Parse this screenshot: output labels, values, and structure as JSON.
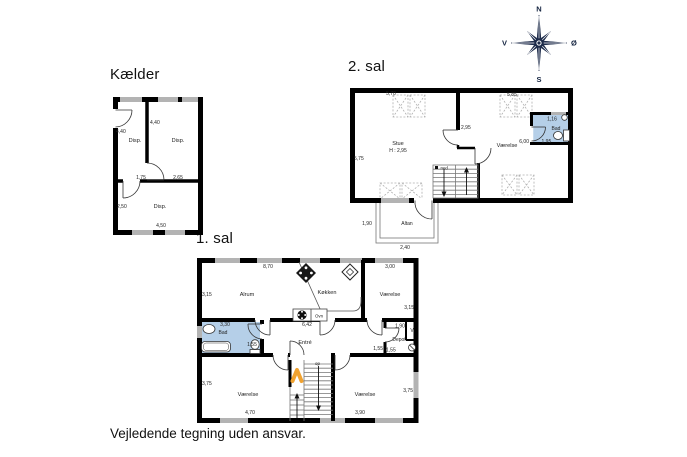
{
  "footer": {
    "disclaimer": "Vejledende tegning uden ansvar."
  },
  "compass": {
    "north": "N",
    "east": "Ø",
    "south": "S",
    "west": "V"
  },
  "colors": {
    "wall": "#000000",
    "window": "#b3b3b3",
    "bath_fill": "#b5cfe8",
    "compass_navy": "#1d2b4a",
    "stair_accent": "#f0a230"
  },
  "kaelder": {
    "title": "Kælder",
    "room_disp_nw": "Disp.",
    "room_disp_ne": "Disp.",
    "room_disp_s": "Disp.",
    "dim_left_440": "4,40",
    "dim_mid_440": "4,40",
    "dim_175": "1,75",
    "dim_265": "2,65",
    "dim_250": "2,50",
    "dim_450": "4,50"
  },
  "sal2": {
    "title": "2. sal",
    "room_stue": "Stue",
    "stue_height": "H : 2,95",
    "room_vaerelse": "Værelse",
    "room_bad": "Bad",
    "room_altan": "Altan",
    "stair_ned": "ned",
    "dim_570": "5,70",
    "dim_585": "5,85",
    "dim_295": "2,95",
    "dim_575": "5,75",
    "dim_116": "1,16",
    "dim_600": "6,00",
    "dim_195": "1,95",
    "dim_190": "1,90",
    "dim_240": "2,40"
  },
  "sal1": {
    "title": "1. sal",
    "room_alrum": "Alrum",
    "room_koekken": "Køkken",
    "room_vaerelse_ne": "Værelse",
    "room_bad": "Bad",
    "room_entre": "Entré",
    "room_depot": "Depot",
    "room_v": "V",
    "label_ovn": "Ovn",
    "stair_op": "op",
    "room_vaerelse_sw": "Værelse",
    "room_vaerelse_se": "Værelse",
    "dim_870": "8,70",
    "dim_300": "3,00",
    "dim_315_left": "3,15",
    "dim_315_right": "3,15",
    "dim_330": "3,30",
    "dim_155_bad": "1,55",
    "dim_642": "6,42",
    "dim_190": "1,90",
    "dim_155_left": "1,55",
    "dim_155_right": "1,55",
    "dim_375_left": "3,75",
    "dim_375_right": "3,75",
    "dim_470": "4,70",
    "dim_390": "3,90"
  }
}
